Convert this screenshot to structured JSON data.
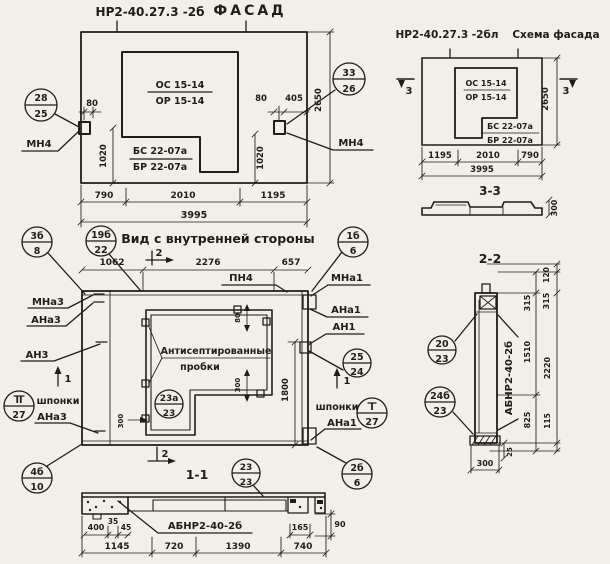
{
  "facade": {
    "code": "НР2-40.27.3 -2б",
    "title": "ФАСАД",
    "window_mark": {
      "top": "ОС 15-14",
      "bottom": "ОР 15-14"
    },
    "panel_mark": {
      "top": "БС 22-07а",
      "bottom": "БР 22-07а"
    },
    "anchor_left_label": "МН4",
    "anchor_right_label": "МН4",
    "callout_left": {
      "top": "28",
      "bottom": "25"
    },
    "callout_right": {
      "top": "33",
      "bottom": "26"
    },
    "dim_80_left": "80",
    "dim_1020_left": "1020",
    "dim_80_right": "80",
    "dim_405_right": "405",
    "dim_1020_right": "1020",
    "dim_height": "2650",
    "dim_w1": "790",
    "dim_w2": "2010",
    "dim_w3": "1195",
    "dim_total": "3995"
  },
  "schema": {
    "code": "НР2-40.27.3 -2бл",
    "title": "Схема фасада",
    "window_mark": {
      "top": "ОС 15-14",
      "bottom": "ОР 15-14"
    },
    "panel_mark": {
      "top": "БС 22-07а",
      "bottom": "БР 22-07а"
    },
    "section_marker": "3",
    "dim_height": "2650",
    "dim_w1": "1195",
    "dim_w2": "2010",
    "dim_w3": "790",
    "dim_total": "3995",
    "section33": {
      "title": "3-3",
      "dim_thickness": "300"
    }
  },
  "view": {
    "title": "Вид с внутренней стороны",
    "dim_w1": "1062",
    "dim_w2": "2276",
    "dim_w3": "657",
    "dim_height": "1800",
    "dim_plug_top": "80",
    "dim_plug_bottom": "300",
    "dim_plug_left": "300",
    "note_line1": "Антисептированные",
    "note_line2": "пробки",
    "label_pn4": "ПН4",
    "marker1": "1",
    "marker2": "2",
    "callout_tl": {
      "top": "3б",
      "bottom": "8"
    },
    "callout_tl2": {
      "top": "19б",
      "bottom": "22"
    },
    "callout_plug": {
      "top": "23а",
      "bottom": "23"
    },
    "left": {
      "mna3": "МНа3",
      "ana3": "АНа3",
      "an3": "АН3",
      "shponki": "шпонки",
      "ana3_b": "АНа3",
      "callout_shponki": {
        "top": "II",
        "bottom": "27"
      },
      "callout_corner": {
        "top": "4б",
        "bottom": "10"
      }
    },
    "right": {
      "mna1": "МНа1",
      "ana1": "АНа1",
      "an1": "АН1",
      "shponki": "шпонки",
      "ana1_b": "АНа1",
      "callout_top": {
        "top": "1б",
        "bottom": "6"
      },
      "callout_mid": {
        "top": "25",
        "bottom": "24"
      },
      "callout_shponki": {
        "top": "I",
        "bottom": "27"
      },
      "callout_corner": {
        "top": "2б",
        "bottom": "6"
      }
    }
  },
  "section11": {
    "title": "1-1",
    "callout": {
      "top": "23",
      "bottom": "23"
    },
    "label": "АБНР2-40-2б",
    "dims": {
      "d400": "400",
      "d35": "35",
      "d45": "45",
      "d165": "165",
      "d90": "90",
      "d1145": "1145",
      "d720": "720",
      "d1390": "1390",
      "d740": "740"
    }
  },
  "section22": {
    "title": "2-2",
    "label": "АБНР2-40-2б",
    "callout_top": {
      "top": "20",
      "bottom": "23"
    },
    "callout_bottom": {
      "top": "24б",
      "bottom": "23"
    },
    "dims": {
      "d120": "120",
      "d315a": "315",
      "d315b": "315",
      "d1510": "1510",
      "d2220": "2220",
      "d825": "825",
      "d115": "115",
      "d25": "25",
      "d300": "300"
    }
  }
}
